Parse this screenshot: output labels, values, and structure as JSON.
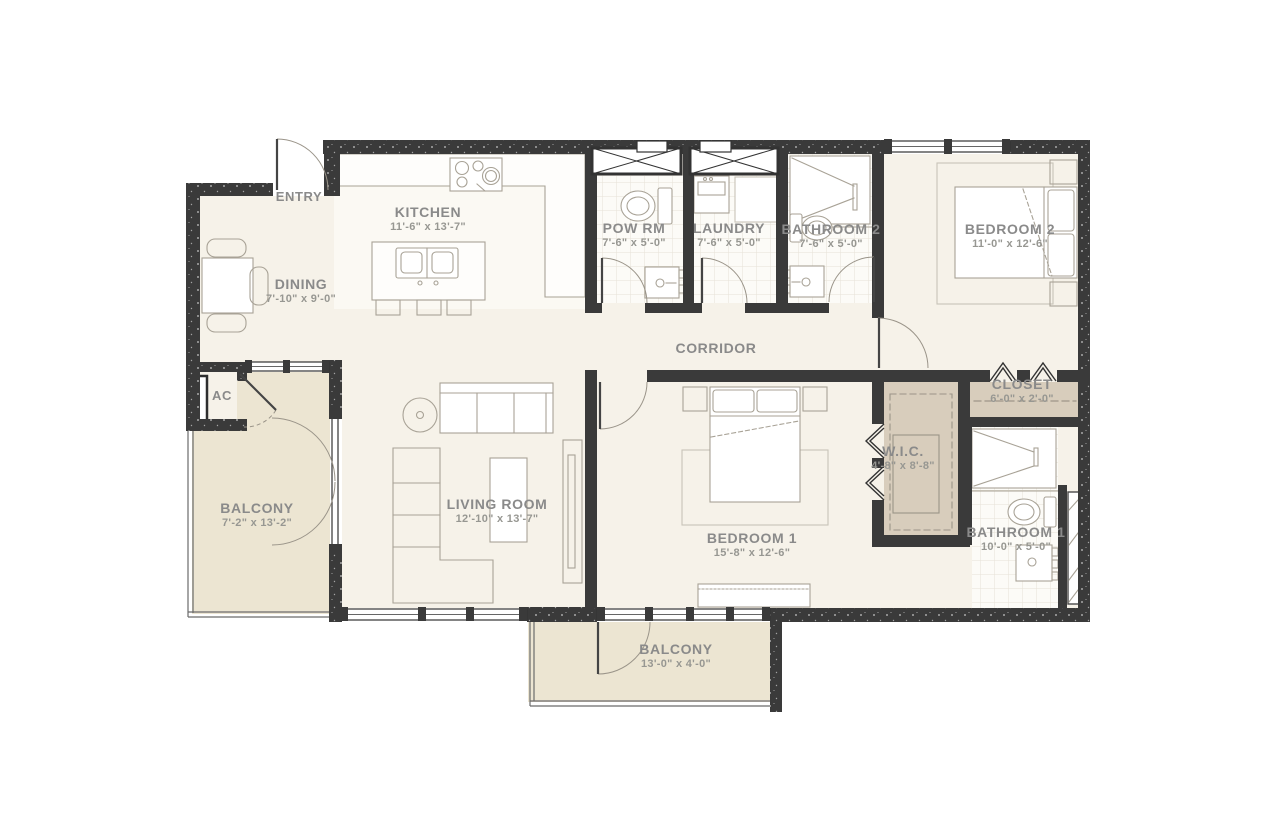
{
  "rooms": [
    {
      "name": "ENTRY",
      "dims": ""
    },
    {
      "name": "KITCHEN",
      "dims": "11'-6\" x 13'-7\""
    },
    {
      "name": "DINING",
      "dims": "7'-10\" x 9'-0\""
    },
    {
      "name": "POW RM",
      "dims": "7'-6\" x 5'-0\""
    },
    {
      "name": "LAUNDRY",
      "dims": "7'-6\" x 5'-0\""
    },
    {
      "name": "BATHROOM 2",
      "dims": "7'-6\" x 5'-0\""
    },
    {
      "name": "BEDROOM 2",
      "dims": "11'-0\" x 12'-6\""
    },
    {
      "name": "CORRIDOR",
      "dims": ""
    },
    {
      "name": "AC",
      "dims": ""
    },
    {
      "name": "CLOSET",
      "dims": "6'-0\" x 2'-0\""
    },
    {
      "name": "W.I.C.",
      "dims": "4'-8\" x 8'-8\""
    },
    {
      "name": "BALCONY",
      "dims": "7'-2\" x 13'-2\""
    },
    {
      "name": "LIVING ROOM",
      "dims": "12'-10\" x 13'-7\""
    },
    {
      "name": "BEDROOM 1",
      "dims": "15'-8\" x 12'-6\""
    },
    {
      "name": "BATHROOM 1",
      "dims": "10'-0\" x 5'-0\""
    },
    {
      "name": "BALCONY",
      "dims": "13'-0\" x 4'-0\""
    }
  ],
  "colors": {
    "wall": "#3a3a3a",
    "floor": "#f6f2e9",
    "kitchenfloor": "#fbf9f3",
    "balcony": "#ece5d2",
    "tan": "#d8cdbc",
    "label": "#8a8a8a",
    "label2": "#979792",
    "line": "#a8a296",
    "ruleline": "#c8c4b8"
  }
}
